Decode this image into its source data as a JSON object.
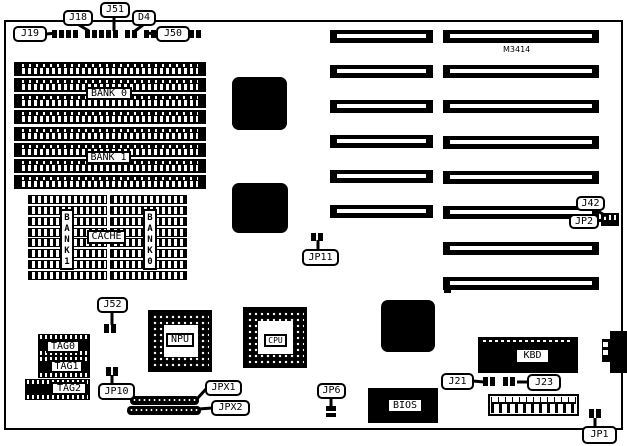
{
  "colors": {
    "ink": "#000000",
    "paper": "#ffffff"
  },
  "board": {
    "model": "M3414"
  },
  "memory": {
    "bank0": "BANK 0",
    "bank1": "BANK 1"
  },
  "cache": {
    "label": "CACHE",
    "bank1_vertical": "BANK1",
    "bank0_vertical": "BANK0",
    "tag0": "TAG0",
    "tag1": "TAG1",
    "tag2": "TAG2"
  },
  "chips": {
    "npu": "NPU",
    "cpu": "CPU",
    "bios": "BIOS",
    "kbd": "KBD"
  },
  "callouts": {
    "j19": "J19",
    "j18": "J18",
    "j51": "J51",
    "d4": "D4",
    "j50": "J50",
    "j42": "J42",
    "jp2": "JP2",
    "jp11": "JP11",
    "j52": "J52",
    "jp10": "JP10",
    "jpx1": "JPX1",
    "jpx2": "JPX2",
    "jp6": "JP6",
    "j21": "J21",
    "j23": "J23",
    "jp1": "JP1"
  }
}
